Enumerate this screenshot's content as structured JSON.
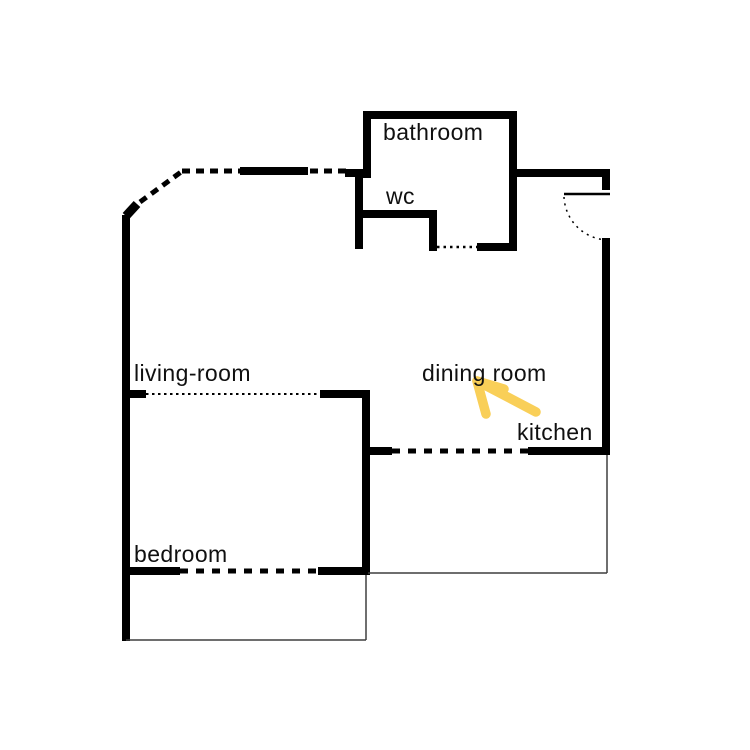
{
  "canvas": {
    "width": 750,
    "height": 750,
    "background": "#ffffff"
  },
  "colors": {
    "wall": "#000000",
    "thin_line": "#3f3f3f",
    "text": "#101010",
    "arrow": "#f9cf58"
  },
  "rooms": [
    {
      "id": "bathroom",
      "label": "bathroom",
      "x": 383,
      "y": 120
    },
    {
      "id": "wc",
      "label": "wc",
      "x": 386,
      "y": 184
    },
    {
      "id": "living-room",
      "label": "living-room",
      "x": 134,
      "y": 361
    },
    {
      "id": "dining-room",
      "label": "dining room",
      "x": 422,
      "y": 361
    },
    {
      "id": "kitchen",
      "label": "kitchen",
      "x": 517,
      "y": 420
    },
    {
      "id": "bedroom",
      "label": "bedroom",
      "x": 134,
      "y": 542
    }
  ],
  "floorplan": {
    "wall_rects": [
      {
        "name": "bathroom-top-wall",
        "x": 363,
        "y": 111,
        "w": 154,
        "h": 8
      },
      {
        "name": "bathroom-left-wall",
        "x": 363,
        "y": 111,
        "w": 8,
        "h": 67
      },
      {
        "name": "bathroom-right-wall",
        "x": 509,
        "y": 111,
        "w": 8,
        "h": 140
      },
      {
        "name": "bathroom-bottom-wall",
        "x": 477,
        "y": 243,
        "w": 40,
        "h": 8
      },
      {
        "name": "hall-top-stub",
        "x": 345,
        "y": 169,
        "w": 18,
        "h": 8
      },
      {
        "name": "wc-left-wall",
        "x": 355,
        "y": 169,
        "w": 8,
        "h": 80
      },
      {
        "name": "wc-bottom-wall",
        "x": 357,
        "y": 210,
        "w": 80,
        "h": 8
      },
      {
        "name": "wc-right-wall",
        "x": 429,
        "y": 210,
        "w": 8,
        "h": 41
      },
      {
        "name": "entry-top-wall",
        "x": 517,
        "y": 169,
        "w": 93,
        "h": 8
      },
      {
        "name": "entry-door-jamb",
        "x": 602,
        "y": 177,
        "w": 8,
        "h": 13
      },
      {
        "name": "right-wall",
        "x": 602,
        "y": 238,
        "w": 8,
        "h": 217
      },
      {
        "name": "kitchen-wall-right",
        "x": 528,
        "y": 447,
        "w": 82,
        "h": 8
      },
      {
        "name": "kitchen-wall-left-stub",
        "x": 370,
        "y": 447,
        "w": 22,
        "h": 8
      },
      {
        "name": "divider-wall",
        "x": 362,
        "y": 390,
        "w": 8,
        "h": 185
      },
      {
        "name": "living-room-wall-right",
        "x": 320,
        "y": 390,
        "w": 50,
        "h": 8
      },
      {
        "name": "living-room-wall-left-stub",
        "x": 122,
        "y": 390,
        "w": 24,
        "h": 8
      },
      {
        "name": "left-wall",
        "x": 122,
        "y": 215,
        "w": 8,
        "h": 426
      },
      {
        "name": "bedroom-wall-left",
        "x": 122,
        "y": 567,
        "w": 58,
        "h": 8
      },
      {
        "name": "bedroom-wall-right",
        "x": 318,
        "y": 567,
        "w": 52,
        "h": 8
      },
      {
        "name": "window-segment-top",
        "x": 240,
        "y": 167,
        "w": 68,
        "h": 8
      }
    ],
    "dashed_lines": [
      {
        "name": "top-dashed-left",
        "x1": 182,
        "y1": 171,
        "x2": 240,
        "y2": 171,
        "width": 5,
        "dash": "8 6"
      },
      {
        "name": "top-dashed-right",
        "x1": 310,
        "y1": 171,
        "x2": 347,
        "y2": 171,
        "width": 5,
        "dash": "8 6"
      },
      {
        "name": "diagonal-dashed",
        "x1": 140,
        "y1": 202,
        "x2": 181,
        "y2": 172,
        "width": 5,
        "dash": "8 6"
      },
      {
        "name": "wc-door-dotted",
        "x1": 437,
        "y1": 247,
        "x2": 477,
        "y2": 247,
        "width": 2.5,
        "dash": "2.5 4"
      },
      {
        "name": "living-room-door-dotted",
        "x1": 146,
        "y1": 394,
        "x2": 320,
        "y2": 394,
        "width": 2,
        "dash": "2.5 3.5"
      },
      {
        "name": "kitchen-door-dashed",
        "x1": 392,
        "y1": 451,
        "x2": 528,
        "y2": 451,
        "width": 5,
        "dash": "8 8"
      },
      {
        "name": "bedroom-door-dashed",
        "x1": 180,
        "y1": 571,
        "x2": 318,
        "y2": 571,
        "width": 5,
        "dash": "8 8"
      }
    ],
    "thin_lines": [
      {
        "name": "terrace-right-line",
        "x1": 607,
        "y1": 455,
        "x2": 607,
        "y2": 573,
        "width": 1.5
      },
      {
        "name": "terrace-bottom-line",
        "x1": 368,
        "y1": 573,
        "x2": 607,
        "y2": 573,
        "width": 1.5
      },
      {
        "name": "balcony-right-line",
        "x1": 366,
        "y1": 575,
        "x2": 366,
        "y2": 640,
        "width": 1.5
      },
      {
        "name": "balcony-bottom-line",
        "x1": 126,
        "y1": 640,
        "x2": 366,
        "y2": 640,
        "width": 1.5
      }
    ],
    "door_leaf": {
      "name": "entry-door-leaf",
      "x1": 564,
      "y1": 194,
      "x2": 610,
      "y2": 194,
      "width": 2.5
    },
    "door_arc": {
      "name": "entry-door-arc",
      "d": "M 564 197 A 45 45 0 0 0 609 240",
      "width": 1.5,
      "dash": "2 4.5"
    },
    "chamfer": {
      "name": "left-wall-chamfer",
      "x1": 126,
      "y1": 216,
      "x2": 137,
      "y2": 204,
      "width": 9
    }
  },
  "annotation": {
    "arrow": {
      "tip_x": 477,
      "tip_y": 381,
      "tail_x": 536,
      "tail_y": 412,
      "barb_down_x": 486,
      "barb_down_y": 414,
      "barb_right_x": 504,
      "barb_right_y": 389,
      "stroke_width": 9.5
    }
  }
}
